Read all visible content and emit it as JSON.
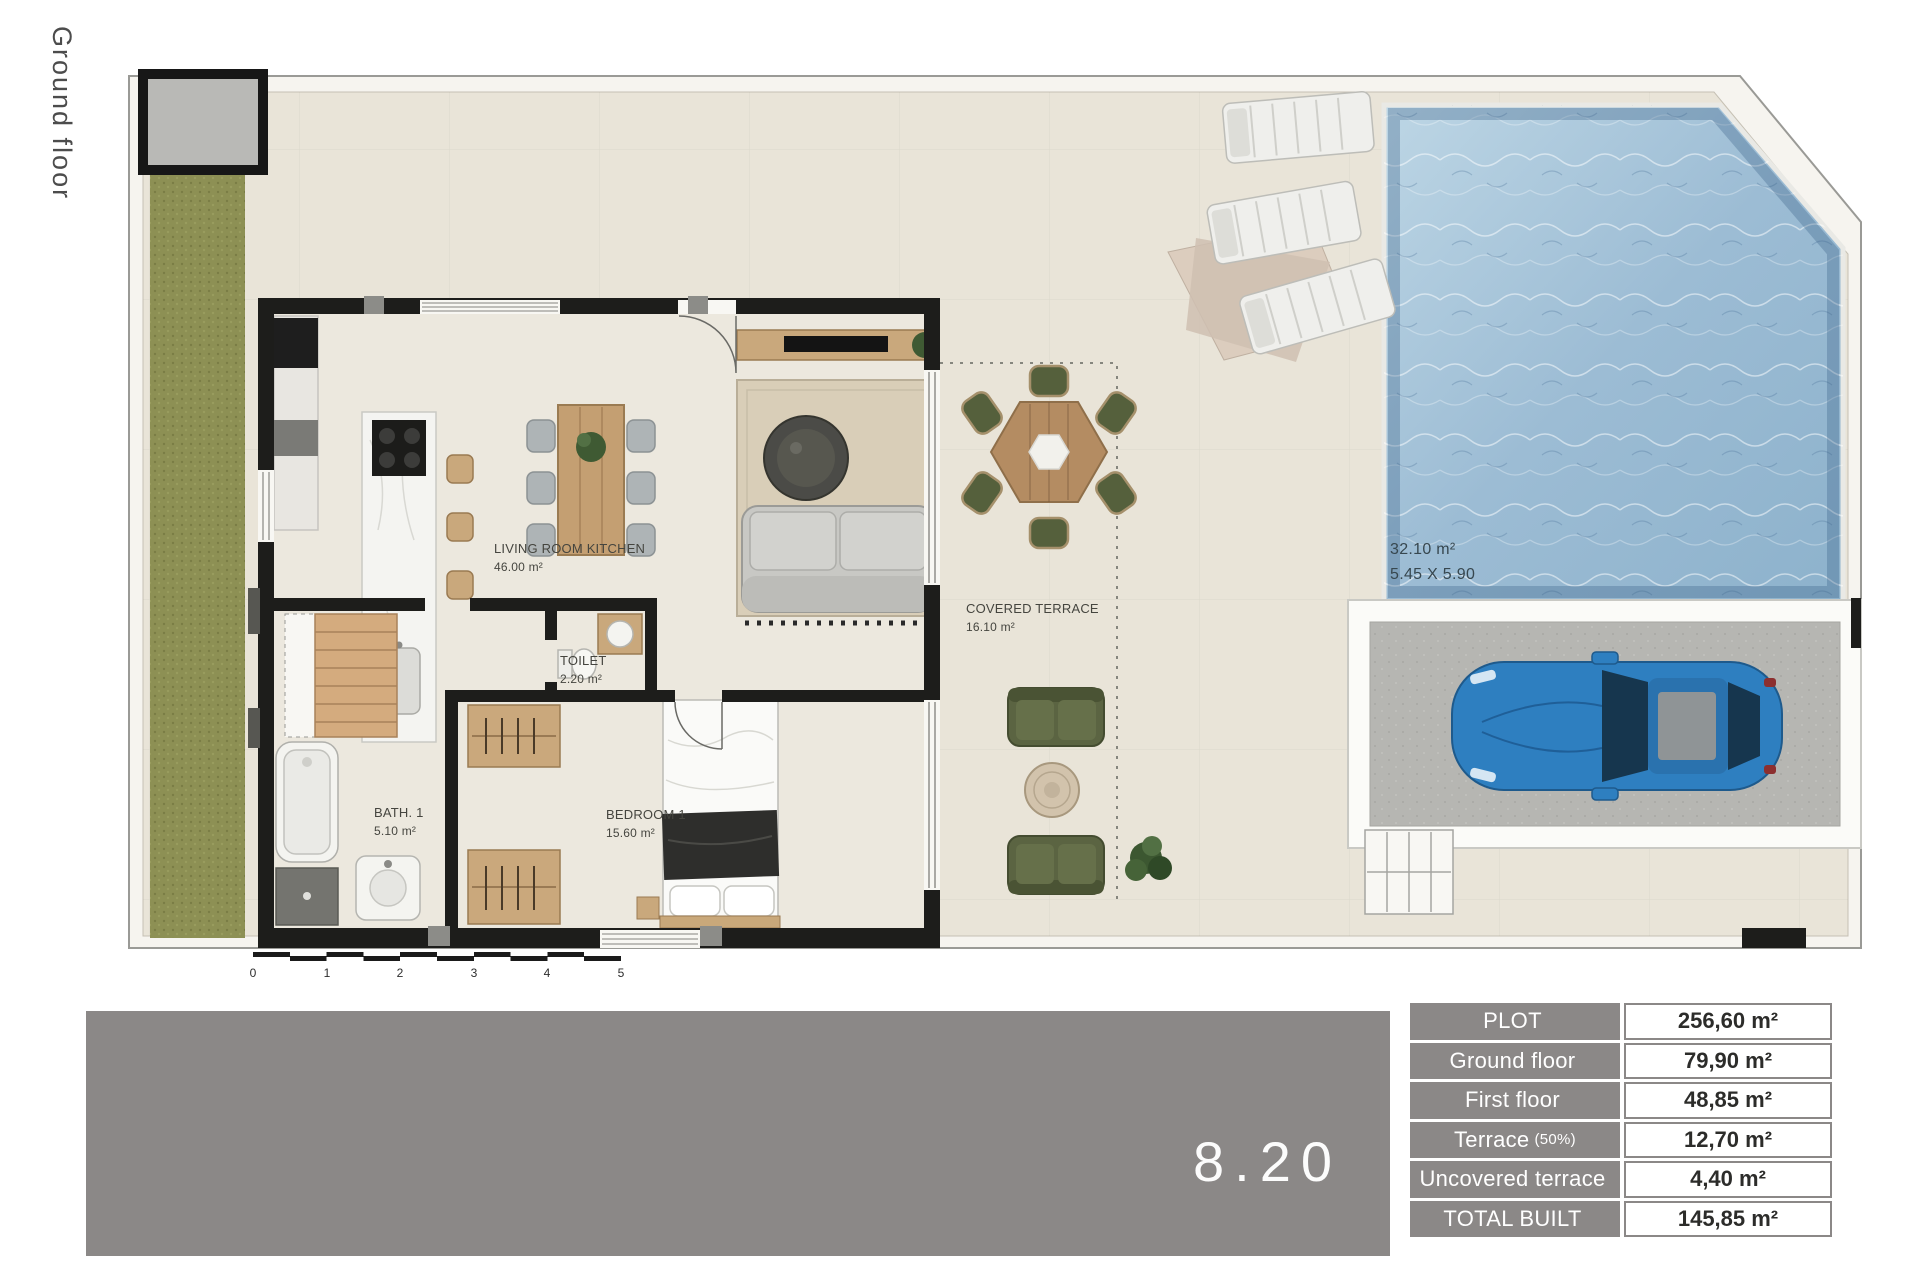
{
  "page": {
    "title": "Ground floor"
  },
  "plan": {
    "rooms": [
      {
        "name": "LIVING ROOM KITCHEN",
        "area": "46.00 m²"
      },
      {
        "name": "TOILET",
        "area": "2.20 m²"
      },
      {
        "name": "BATH. 1",
        "area": "5.10 m²"
      },
      {
        "name": "BEDROOM 1",
        "area": "15.60 m²"
      },
      {
        "name": "COVERED TERRACE",
        "area": "16.10 m²"
      }
    ],
    "pool": {
      "area": "32.10 m²",
      "dimensions": "5.45 X 5.90"
    },
    "scale_bar": {
      "ticks": [
        "0",
        "1",
        "2",
        "3",
        "4",
        "5"
      ]
    }
  },
  "banner": {
    "plan_number": "8.20"
  },
  "areas_table": {
    "rows": [
      {
        "label": "PLOT",
        "note": "",
        "value": "256,60 m²"
      },
      {
        "label": "Ground floor",
        "note": "",
        "value": "79,90 m²"
      },
      {
        "label": "First floor",
        "note": "",
        "value": "48,85 m²"
      },
      {
        "label": "Terrace",
        "note": "(50%)",
        "value": "12,70 m²"
      },
      {
        "label": "Uncovered terrace",
        "note": "",
        "value": "4,40 m²"
      },
      {
        "label": "TOTAL BUILT",
        "note": "",
        "value": "145,85 m²"
      }
    ]
  },
  "colors": {
    "floor_beige": "#e9e4d8",
    "grass_green": "#8d9054",
    "pool_blue": "#9cbcd4",
    "wall_black": "#1d1d1b",
    "wood_tan": "#c9a87c",
    "banner_gray": "#8b8887",
    "table_gray": "#8b8887",
    "car_blue": "#2e7fc0",
    "outdoor_chair_green": "#55603c",
    "parking_gray": "#b6b6b2"
  }
}
